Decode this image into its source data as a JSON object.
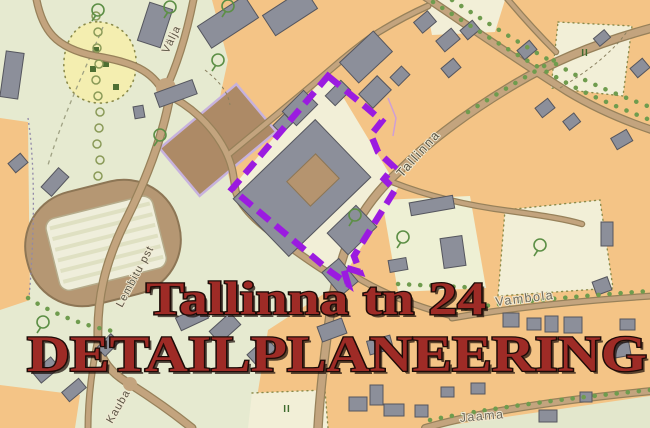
{
  "title": {
    "line1": "Tallinna tn 24",
    "line2": "DETAILPLANEERING"
  },
  "streets": {
    "valja": "Välja",
    "tallinna": "Tallinna",
    "lembitu": "Lembitu pst",
    "kauba": "Kauba",
    "vambola": "Vambola",
    "jaama": "Jaama"
  },
  "map": {
    "orchard_symbol": "II",
    "boundary_meaning": "planning-area-boundary"
  },
  "colors": {
    "boundary_purple": "#9b1be0",
    "title_red": "#9e2b26",
    "title_outline": "#1d0b07",
    "block_orange": "#f4c486",
    "park_green": "#e6ead0",
    "block_cream": "#f2efd7",
    "yellow_area": "#f4eeb0",
    "road_tan": "#c3a47e",
    "road_casing": "#97815a",
    "building_gray": "#8c8f9a",
    "building_outline": "#55565e",
    "field_brown": "#ad8a66",
    "field_border_lavender": "#c7b2dd",
    "tree_green": "#6f9c4e",
    "label_gray": "#5a5444"
  }
}
